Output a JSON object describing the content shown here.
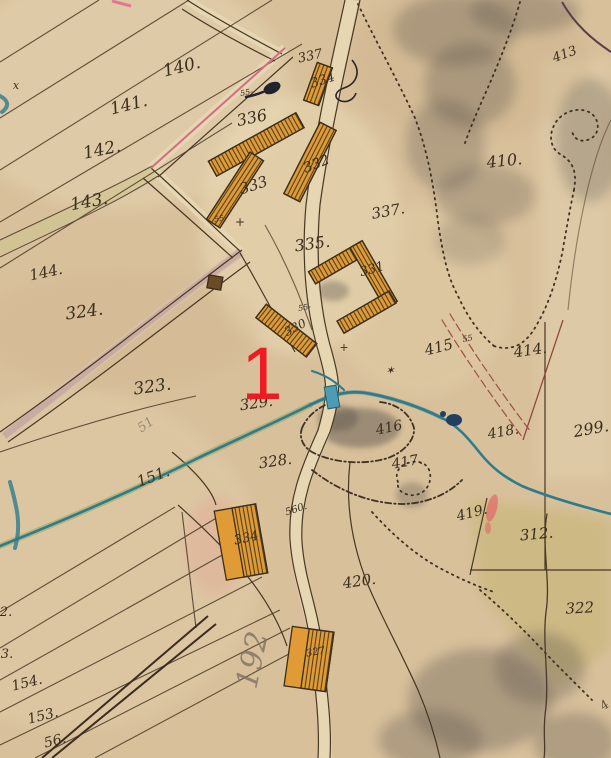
{
  "map": {
    "description": "hand-drawn historical cadastral map scan",
    "marker": {
      "text": "1",
      "color": "#ee1b23"
    },
    "labels": {
      "f140": "140.",
      "f141": "141.",
      "f142": "142.",
      "f143": "143.",
      "f144": "144.",
      "f151": "151.",
      "f153": "153.",
      "f154": "154.",
      "f156": "56.",
      "edge2": "2.",
      "edge3": "3.",
      "p299": "299.",
      "p312": "312.",
      "p322": "322",
      "p323": "323.",
      "p324": "324.",
      "p328": "328.",
      "p329": "329.",
      "b330": "330",
      "b331": "331",
      "b332": "332",
      "b333": "333",
      "b334_top": "334",
      "b334_south": "334",
      "b327": "327",
      "p335": "335.",
      "p336": "336",
      "p337_upper": "337",
      "p337_lower": "337.",
      "p410": "410.",
      "p413": "413",
      "p414": "414.",
      "p415": "415",
      "p416": "416",
      "p417": "417.",
      "p418": "418.",
      "p419": "419.",
      "p420": "420.",
      "p560": "560.",
      "pencil51": "51",
      "pencil192": "192",
      "m55a": "55-",
      "m55b": "55-",
      "m55c": "55-",
      "m55d": "55",
      "xmark": "x",
      "star": "✶",
      "cross_a": "+",
      "cross_b": "+",
      "frag44": "4"
    },
    "colors": {
      "paper": "#d8c09b",
      "ink": "#3a2e1f",
      "water": "#2e7b8c",
      "building": "#e09b36",
      "pink_road": "#e2788f",
      "red_marker": "#ee1b23",
      "gray_wash": "#55504a",
      "meadow": "#b4aa50"
    }
  }
}
